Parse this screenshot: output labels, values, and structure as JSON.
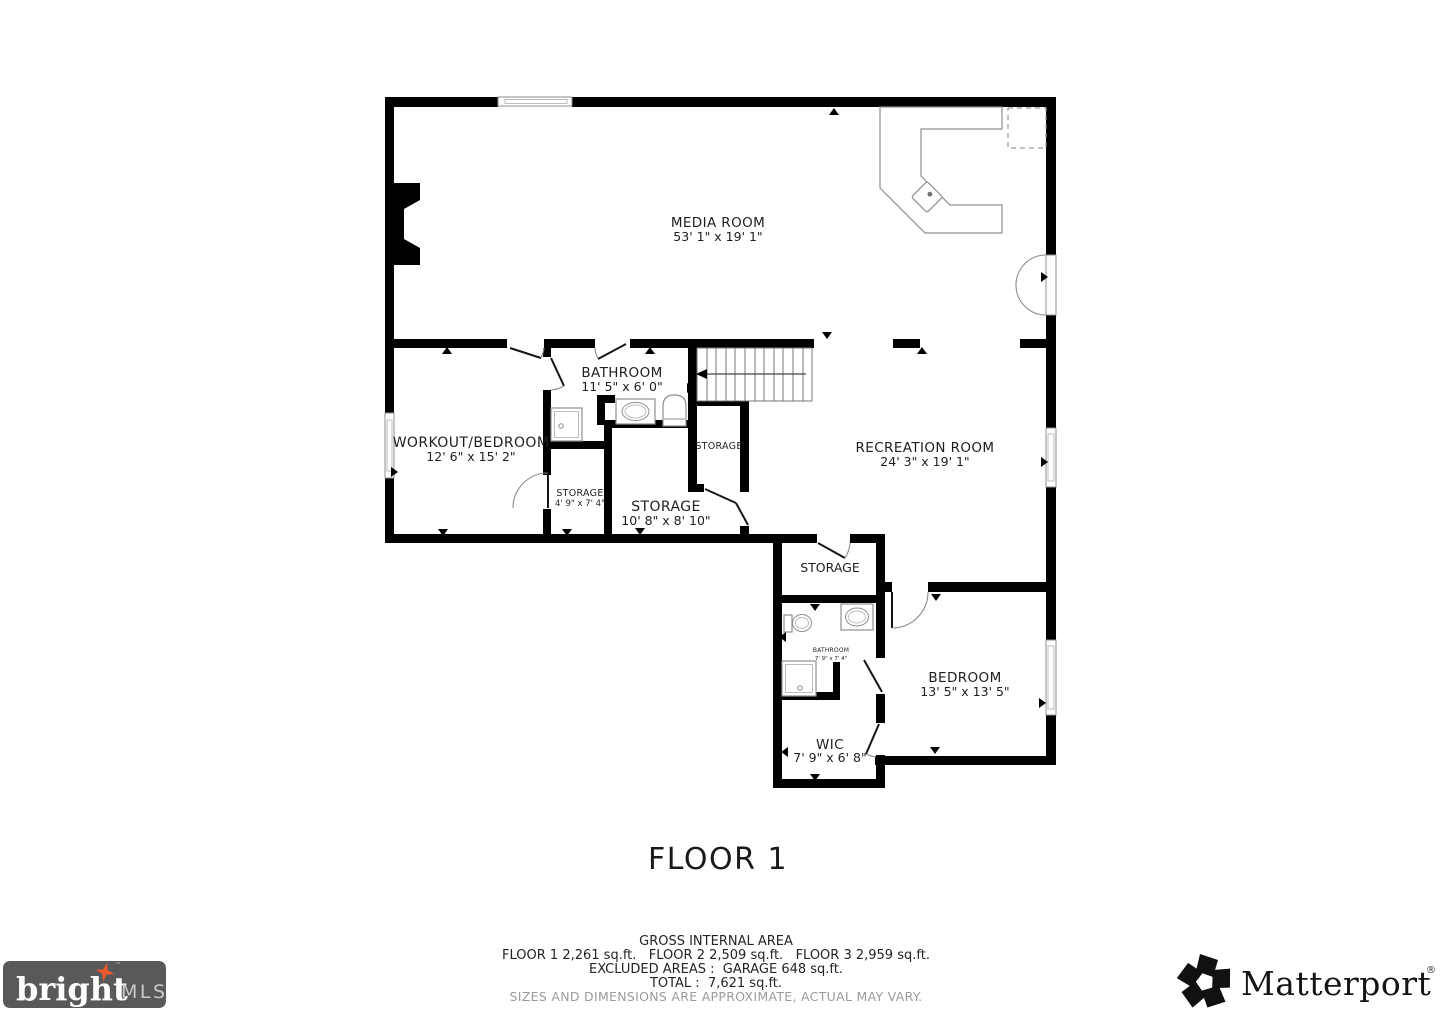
{
  "plan": {
    "floor_label": "FLOOR 1",
    "rooms": {
      "media": {
        "name": "MEDIA ROOM",
        "dims": "53' 1\" x 19' 1\""
      },
      "workout": {
        "name": "WORKOUT/BEDROOM",
        "dims": "12' 6\" x 15' 2\""
      },
      "bathroom_upper": {
        "name": "BATHROOM",
        "dims": "11' 5\" x 6' 0\""
      },
      "storage_small": {
        "name": "STORAGE",
        "dims": "4' 9\" x 7' 4\""
      },
      "storage_large": {
        "name": "STORAGE",
        "dims": "10' 8\" x 8' 10\""
      },
      "storage_under_stairs": {
        "name": "STORAGE"
      },
      "recreation": {
        "name": "RECREATION ROOM",
        "dims": "24' 3\" x 19' 1\""
      },
      "storage_mid": {
        "name": "STORAGE"
      },
      "bathroom_lower": {
        "name": "BATHROOM",
        "dims": "7' 9\" x 7' 4\""
      },
      "bedroom": {
        "name": "BEDROOM",
        "dims": "13' 5\" x 13' 5\""
      },
      "wic": {
        "name": "WIC",
        "dims": "7' 9\" x 6' 8\""
      }
    }
  },
  "footer": {
    "area_title": "GROSS INTERNAL AREA",
    "floors_line": "FLOOR 1 2,261 sq.ft.   FLOOR 2 2,509 sq.ft.   FLOOR 3 2,959 sq.ft.",
    "excluded_line": "EXCLUDED AREAS :  GARAGE 648 sq.ft.",
    "total_line": "TOTAL :  7,621 sq.ft.",
    "disclaimer": "SIZES AND DIMENSIONS ARE APPROXIMATE, ACTUAL MAY VARY."
  },
  "logos": {
    "bright": {
      "word": "bright",
      "suffix": "MLS",
      "tm": "™"
    },
    "matterport": {
      "word": "Matterport",
      "reg": "®"
    }
  },
  "colors": {
    "wall": "#000000",
    "fixture_line": "#8f8f8f",
    "label_text": "#1f1f1f",
    "disclaimer_text": "#9b9b9b",
    "bright_box": "#58595b",
    "bright_star": "#e8582b",
    "matterport_mark": "#111111"
  }
}
